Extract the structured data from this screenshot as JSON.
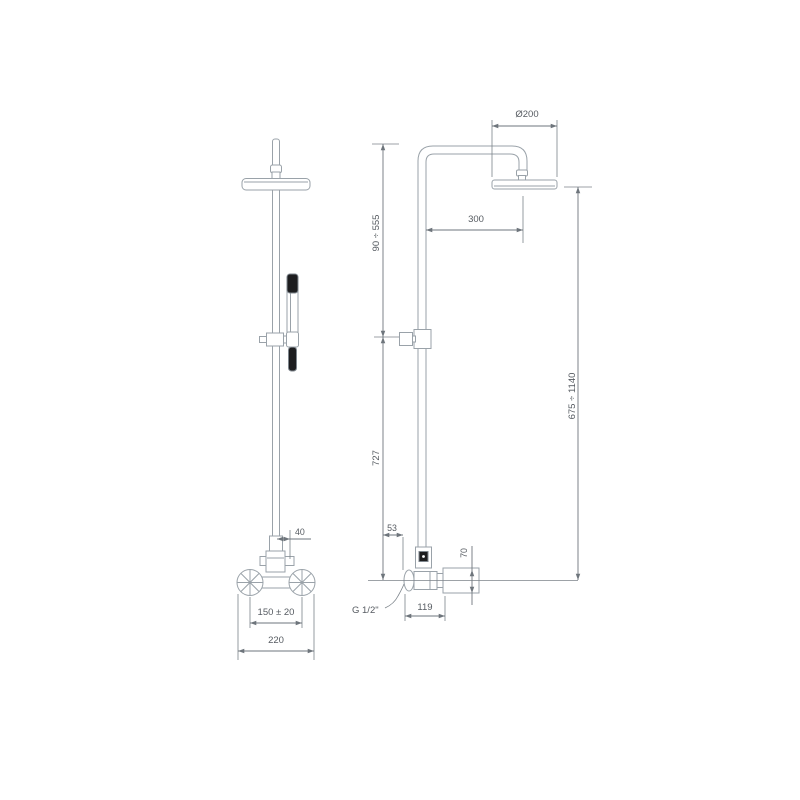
{
  "drawing": {
    "type": "technical dimension drawing",
    "subject": "shower column with overhead shower, hand shower and exposed mixer",
    "units": "mm",
    "colors": {
      "background": "#ffffff",
      "fixture_line": "#9aa2a9",
      "dimension_line": "#6e757c",
      "text": "#565b61",
      "dark_fill": "#1d1d1f"
    },
    "front_view": {
      "name": "front view",
      "dimensions": {
        "knob_offset": "40",
        "inlet_spacing": "150 ± 20",
        "overall_width": "220"
      }
    },
    "side_view": {
      "name": "side view",
      "dimensions": {
        "head_diameter": "Ø200",
        "arm_reach": "300",
        "upper_tube_range": "90 ÷ 555",
        "overall_height_range": "675 ÷ 1140",
        "lower_tube_height": "727",
        "slider_offset": "53",
        "wall_block_height": "70",
        "valve_depth": "119",
        "thread_label": "G 1/2\""
      }
    }
  }
}
